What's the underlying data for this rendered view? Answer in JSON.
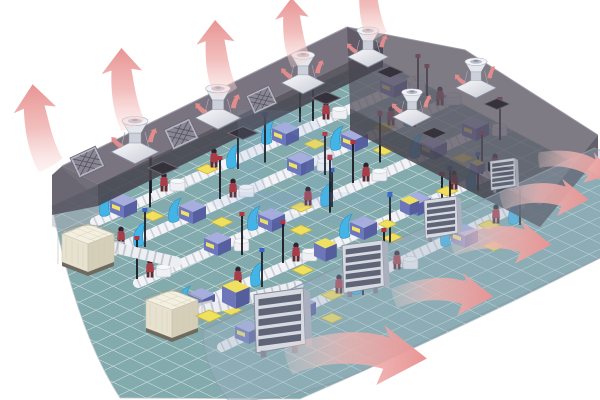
{
  "meta": {
    "type": "technical-illustration",
    "subject": "Industrial workshop ventilation and cooling airflow cutaway",
    "canvas": {
      "width": 600,
      "height": 400
    },
    "background": "#ffffff"
  },
  "colors": {
    "background": "#ffffff",
    "floor": "#83abae",
    "floor_grid": "#eef6f5",
    "roof": "#5b5663",
    "roof_edge": "#48444f",
    "wall_glass": "#9fb2c4",
    "arrow_pink": "#e89493",
    "arrow_mid": "#efb3b1",
    "arrow_tail": "#f7d9d7",
    "fan_metal": "#e9ebf1",
    "louver_face": "#d7dae2",
    "louver_slat": "#5f6576",
    "cooler_cream": "#f3efe1",
    "machine_blue": "#6d77bd",
    "accent_yellow": "#f1df5e",
    "worker_maroon": "#a63d48",
    "deflector_cyan": "#43b4e6",
    "duct_white": "#f2f3f6",
    "pole_black": "#191820",
    "watermark_blue": "#7f9fd4"
  },
  "scene": {
    "building": {
      "label": "factory-building-cutaway"
    },
    "roof": {
      "label": "translucent-cutaway-roof"
    },
    "roof_fans": {
      "label": "roof-exhaust-fan",
      "count": 6
    },
    "roof_openings": {
      "label": "roof-duct-opening",
      "count": 6
    },
    "roof_grilles": {
      "label": "roof-grille-panel",
      "count": 3
    },
    "floor": {
      "label": "workshop-grid-floor"
    },
    "production_rows": {
      "label": "production-line",
      "count": 5
    },
    "cooling_units": {
      "label": "evaporative-cooler-unit",
      "count": 2
    },
    "supply_ducts": {
      "label": "supply-air-duct",
      "count": 2
    },
    "front_wall": {
      "label": "translucent-front-wall"
    },
    "wall_louvers": {
      "label": "exhaust-louver-vent",
      "count": 4
    },
    "exhaust_fan_boxes": {
      "label": "exhaust-fan-box",
      "count": 4
    },
    "airflow": {
      "roof_arrows": {
        "label": "roof-exhaust-airflow-arrow",
        "count": 5,
        "direction": "up"
      },
      "wall_arrows": {
        "label": "wall-exhaust-airflow-arrow",
        "count": 5,
        "direction": "down-right"
      },
      "fan_swirls": {
        "label": "fan-exhaust-swirl-arrow",
        "count": 12,
        "direction": "outward"
      }
    },
    "watermark": {
      "letter": "D"
    }
  }
}
